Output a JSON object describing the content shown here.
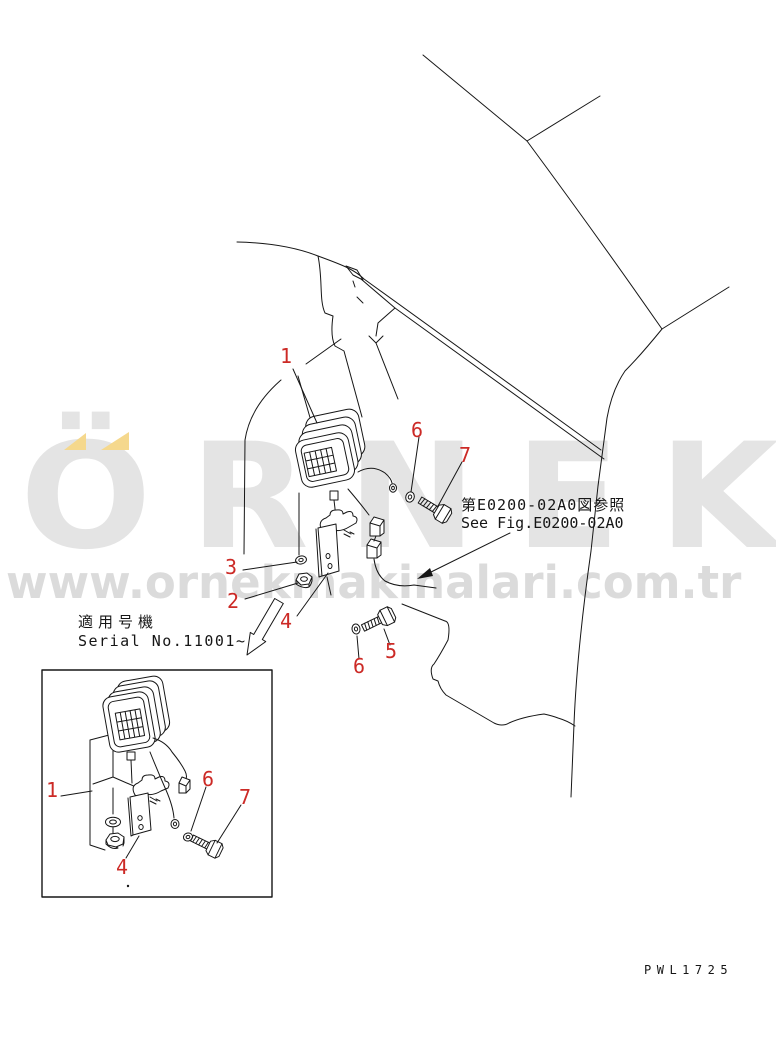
{
  "page": {
    "background": "#ffffff"
  },
  "watermark": {
    "brand": "ÖRNEK",
    "url": "www.ornekmakinalari.com.tr",
    "brand_color": "#e4e4e4",
    "url_color": "#dbdbdb",
    "accent_yellow": "#f5d88d"
  },
  "figure": {
    "reference_note_jp": "第E0200-02A0図参照",
    "reference_note_en": "See Fig.E0200-02A0",
    "applicability_label_jp": "適用号機",
    "applicability_label_en": "Serial No.11001~",
    "drawing_code": "PWL1725",
    "callout_color": "#cc2a26",
    "line_color": "#161616"
  },
  "callouts": {
    "main_view": [
      "1",
      "3",
      "2",
      "4",
      "6",
      "7",
      "6",
      "5"
    ],
    "inset_view": [
      "1",
      "6",
      "7",
      "4"
    ]
  }
}
